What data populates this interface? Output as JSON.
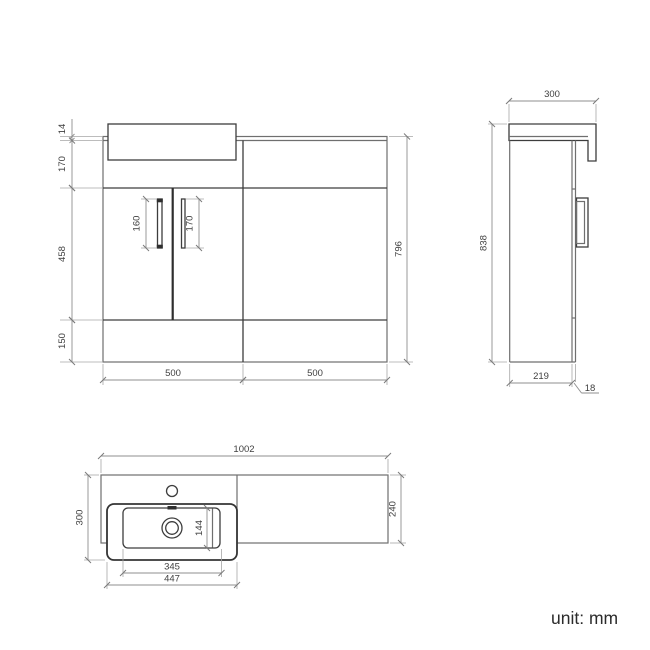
{
  "drawing": {
    "unit_label": "unit: mm",
    "front": {
      "countertop_thickness": "14",
      "upper_panel_height": "170",
      "door_height": "458",
      "plinth_height": "150",
      "left_handle_length": "160",
      "right_handle_length": "170",
      "overall_height": "796",
      "vanity_width": "500",
      "wc_width": "500"
    },
    "side": {
      "worktop_depth": "300",
      "overall_height": "838",
      "cabinet_depth": "219",
      "panel_thickness": "18"
    },
    "plan": {
      "overall_width": "1002",
      "basin_overall_depth": "300",
      "worktop_depth": "240",
      "bowl_inner_depth": "144",
      "bowl_inner_width": "345",
      "basin_width": "447"
    }
  }
}
